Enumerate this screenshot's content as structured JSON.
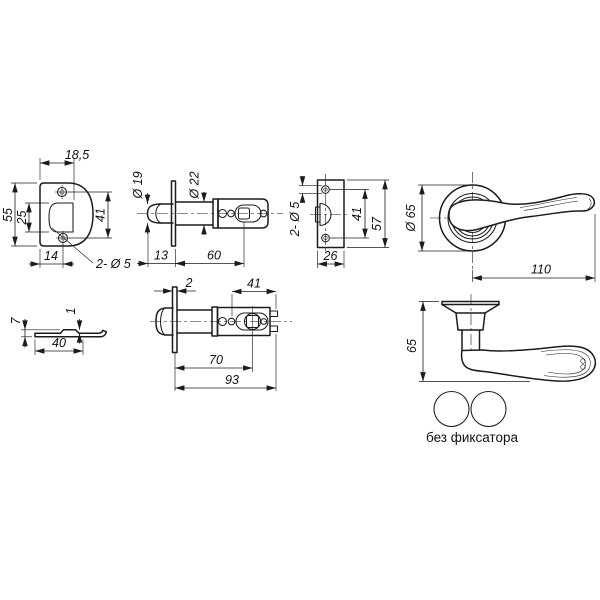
{
  "ink": "#1c1c1c",
  "background": "#ffffff",
  "caption": {
    "variant_label": "без фиксатора"
  },
  "views": {
    "strike_plate_front": {
      "dims": {
        "top_width": "18,5",
        "height": "55",
        "opening_height": "25",
        "hole_spacing": "41",
        "bottom_offset": "14",
        "holes_callout": "2- Ø 5"
      }
    },
    "latch_bolt_side": {
      "dims": {
        "bolt_diameter": "Ø 19",
        "body_diameter": "Ø 22",
        "bolt_length": "13",
        "body_length": "60"
      }
    },
    "latch_faceplate": {
      "dims": {
        "holes_callout": "2- Ø 5",
        "hole_spacing": "41",
        "height": "57",
        "width": "26"
      }
    },
    "handle_front": {
      "dims": {
        "rose_diameter": "Ø 65",
        "handle_length": "110"
      }
    },
    "strike_plate_side": {
      "dims": {
        "lip_height": "7",
        "thickness": "1",
        "length": "40"
      }
    },
    "latch_bolt_top": {
      "dims": {
        "plate_thickness": "2",
        "rear_length": "41",
        "backset": "70",
        "total_length": "93"
      }
    },
    "handle_side": {
      "dims": {
        "height": "65"
      }
    }
  }
}
